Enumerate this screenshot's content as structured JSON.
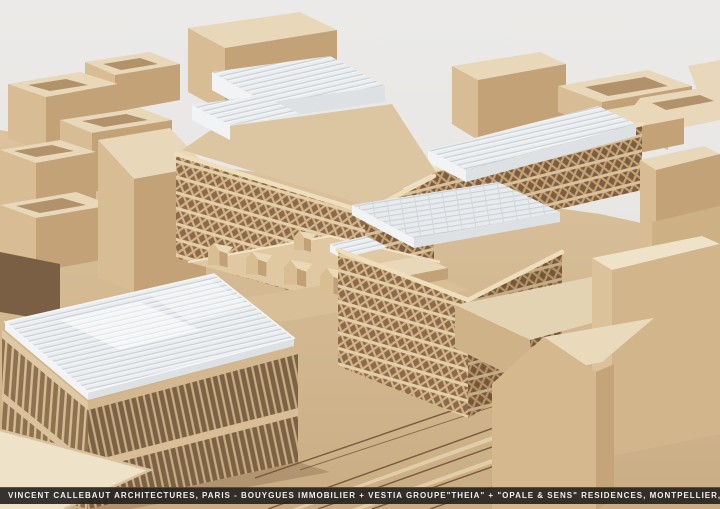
{
  "window": {
    "width": 720,
    "height": 509
  },
  "photo": {
    "subject": "wooden architectural scale model of residential urban blocks, three-quarter aerial view",
    "elements": [
      "plain wood context blocks with courtyards",
      "lattice-facade residence buildings with white translucent rooftops",
      "glass-roof building with slatted facade",
      "rooftop terrace with small gable cabins",
      "street grid engraved on wooden baseboard"
    ]
  },
  "caption_bar": {
    "left_text": "VINCENT CALLEBAUT ARCHITECTURES, PARIS - BOUYGUES IMMOBILIER + VESTIA GROUPE",
    "right_text": "\"THEIA\" + \"OPALE & SENS\" RESIDENCES, MONTPELLIER, FRANCE"
  },
  "palette": {
    "background": "#e9e8e6",
    "wood_top": "#e8d8b9",
    "wood_light": "#d7bc94",
    "wood_mid": "#c3a277",
    "wood_shadow": "#8a6a4a",
    "roof_white": "#eaedef",
    "roof_line": "#c9cfd5",
    "ground": "#d7bd98",
    "street_line": "#7a5a3c",
    "caption_background": "#262321",
    "caption_text": "#efefec"
  }
}
